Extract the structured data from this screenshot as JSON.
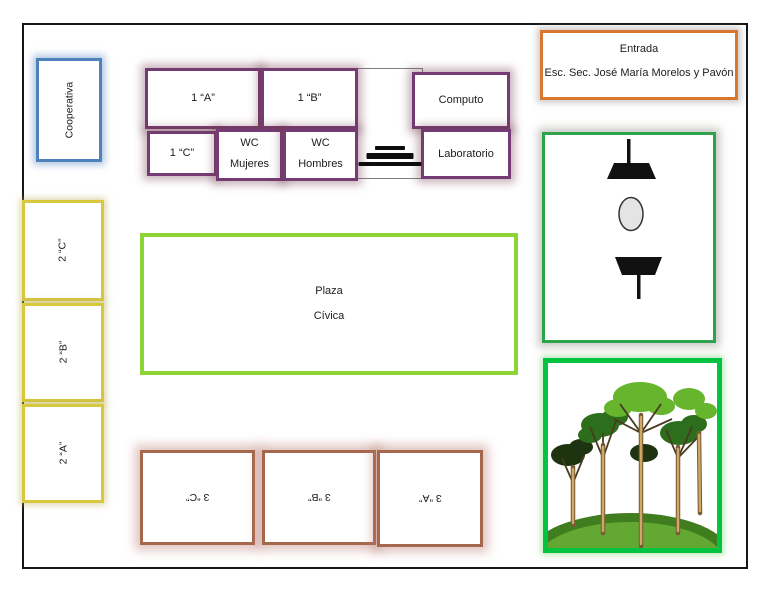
{
  "page": {
    "background": "#ffffff",
    "border_color": "#161616"
  },
  "entrance": {
    "title": "Entrada",
    "school": "Esc. Sec. José María Morelos y Pavón",
    "border_color": "#d8772f"
  },
  "cooperativa": {
    "label": "Cooperativa",
    "border_color": "#4f81bd"
  },
  "first_grade_block": {
    "border_color": "#743b74",
    "room_1a": "1 “A”",
    "room_1b": "1 “B”",
    "room_1c": "1 “C”",
    "computo": "Computo",
    "laboratorio": "Laboratorio",
    "wc_mujeres": {
      "line1": "WC",
      "line2": "Mujeres"
    },
    "wc_hombres": {
      "line1": "WC",
      "line2": "Hombres"
    },
    "stairs_icon": "stairs-icon"
  },
  "second_grade_block": {
    "border_color": "#d7c83e",
    "room_2c": "2 “C”",
    "room_2b": "2 “B”",
    "room_2a": "2 “A”"
  },
  "third_grade_block": {
    "border_color": "#a5684c",
    "room_3c": "3 “C”",
    "room_3b": "3 “B”",
    "room_3a": "3 “A”"
  },
  "plaza": {
    "line1": "Plaza",
    "line2": "Cívica",
    "border_color": "#8dd437"
  },
  "courtyard": {
    "border_color": "#2fa24c",
    "icons": [
      "bench-top-icon",
      "oval-table-icon",
      "bench-bottom-icon"
    ]
  },
  "garden": {
    "border_color": "#04c340",
    "icon": "trees-illustration"
  }
}
